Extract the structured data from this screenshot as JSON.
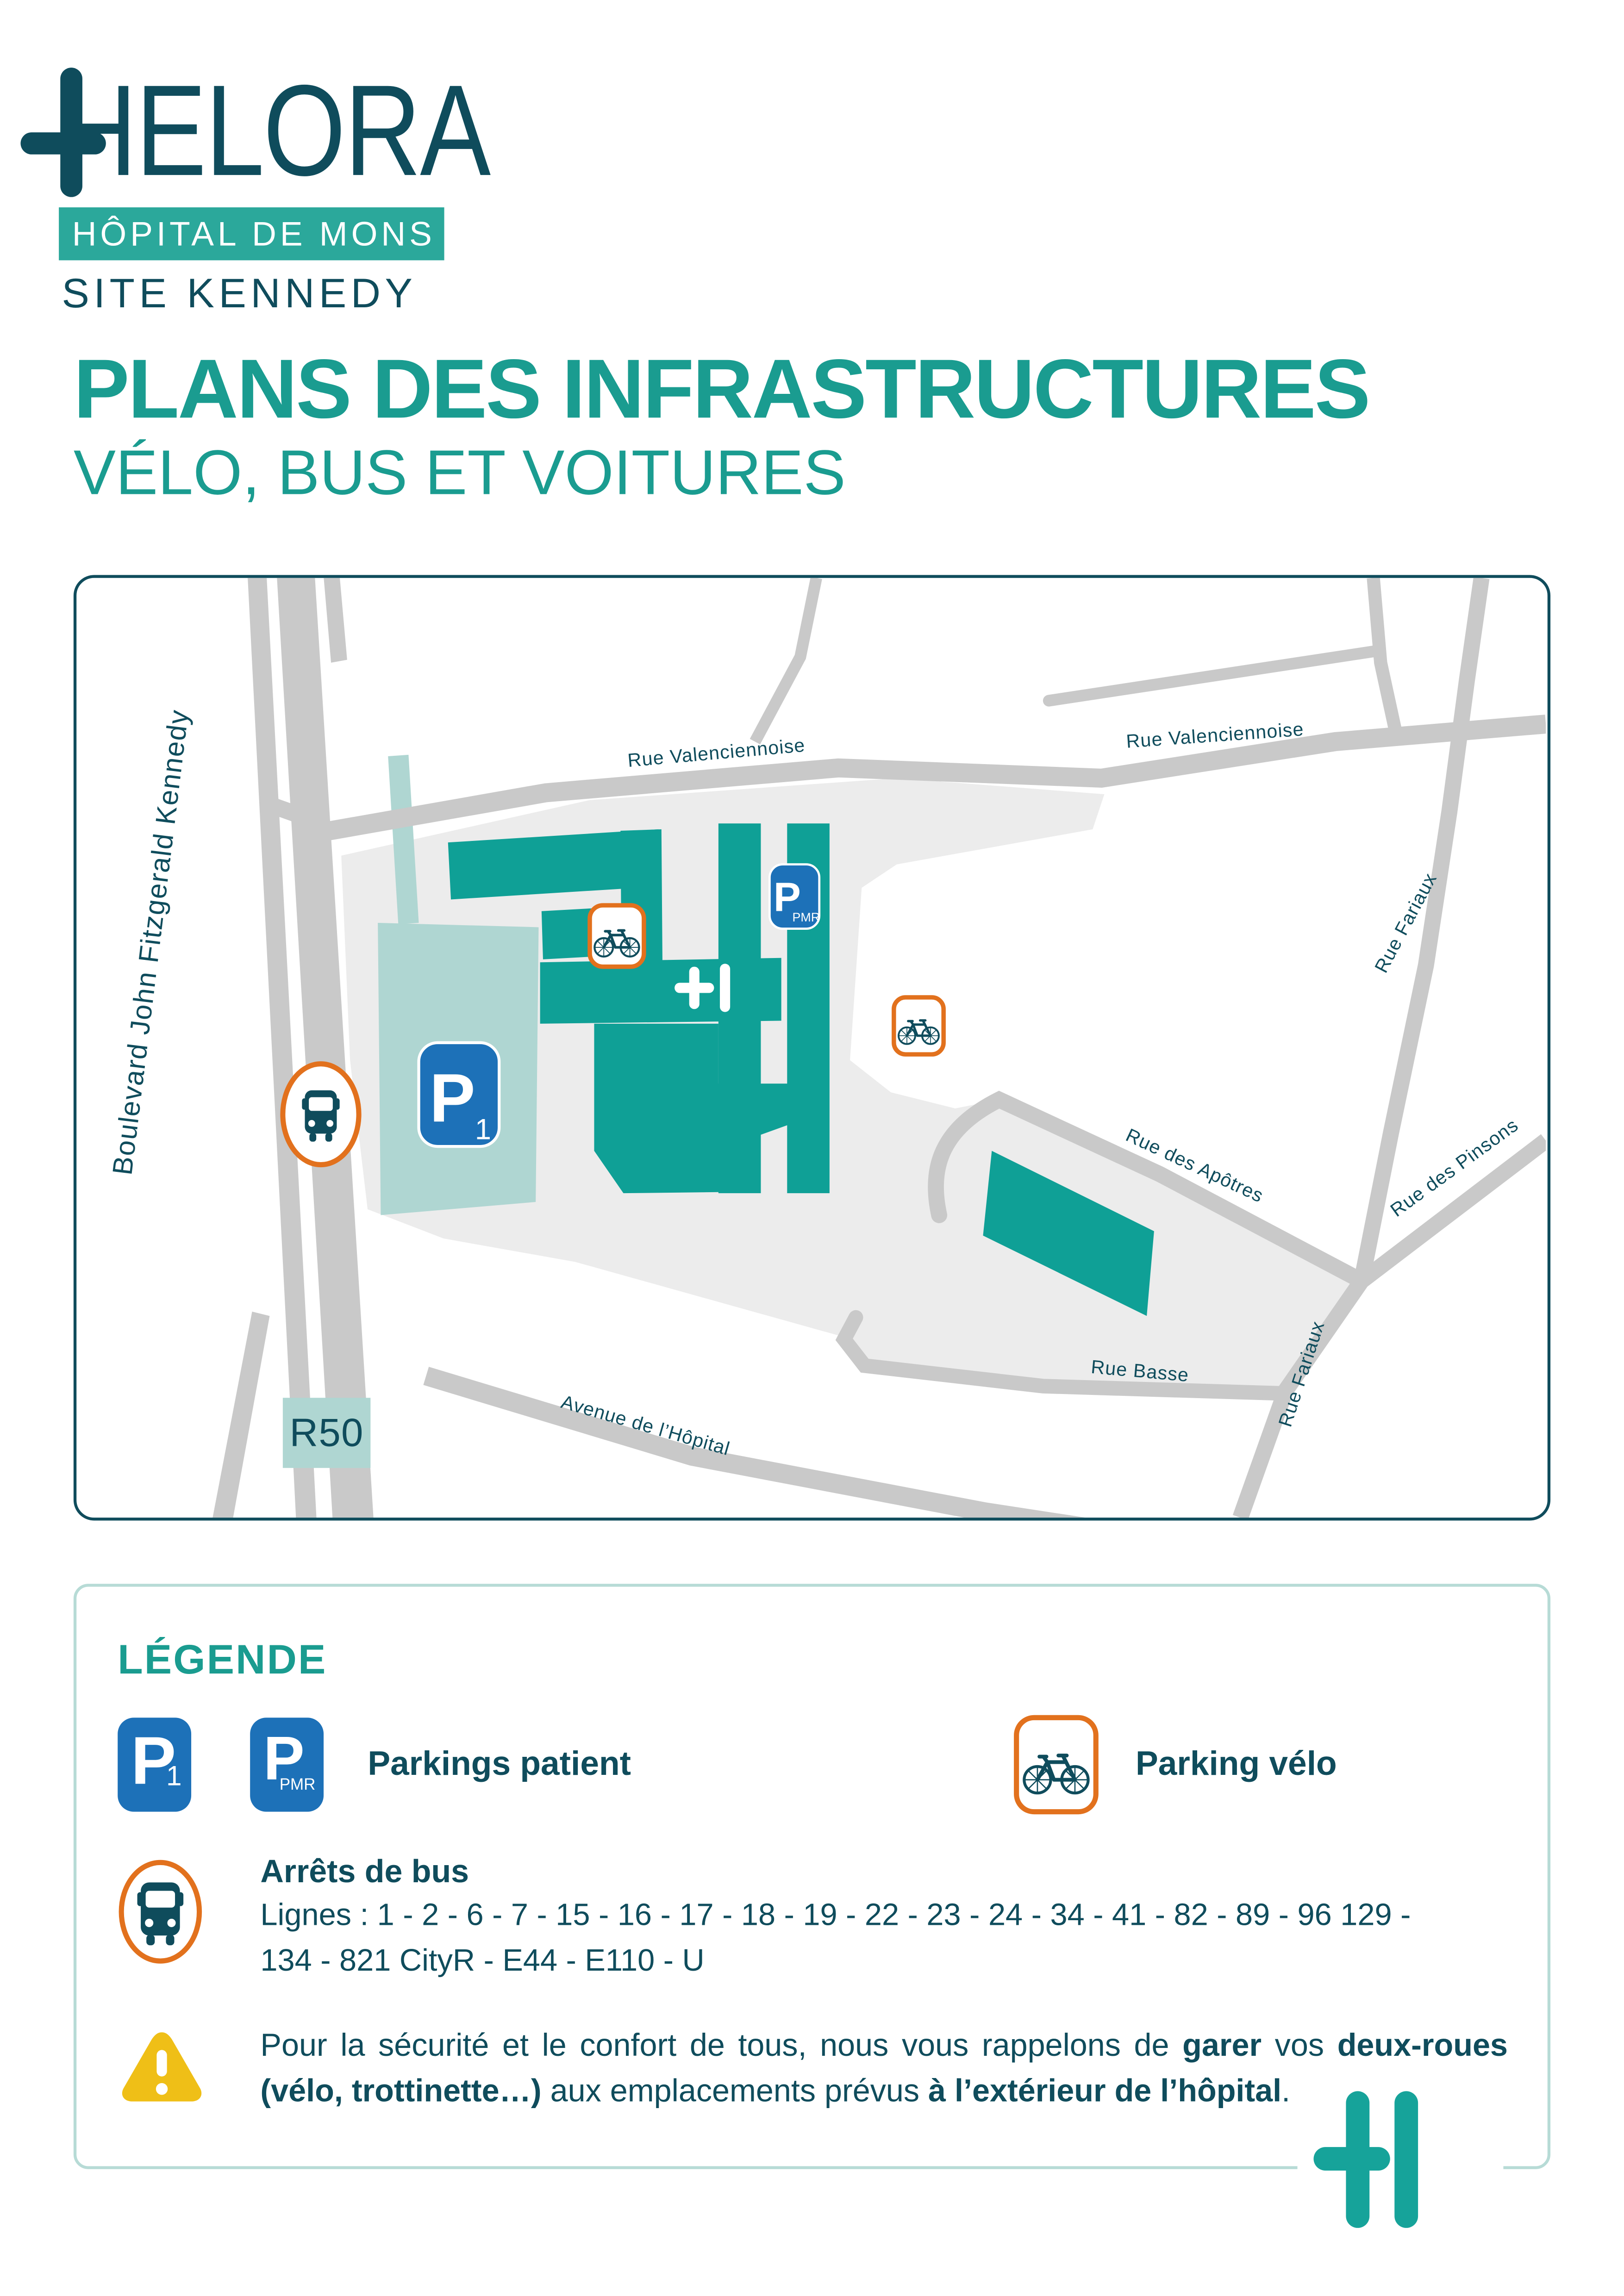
{
  "brand": {
    "wordmark": "HELORA",
    "hospital": "HÔPITAL DE MONS",
    "site": "SITE KENNEDY"
  },
  "title": {
    "line1": "PLANS DES INFRASTRUCTURES",
    "line2": "VÉLO, BUS ET VOITURES"
  },
  "map": {
    "streets": {
      "boulevard": "Boulevard John Fitzgerald Kennedy",
      "valenciennoise": "Rue Valenciennoise",
      "fariaux": "Rue Fariaux",
      "pinsons": "Rue des Pinsons",
      "apotres": "Rue des Apôtres",
      "basse": "Rue Basse",
      "avenue": "Avenue de l’Hôpital",
      "ring": "R50"
    },
    "signs": {
      "p": "P",
      "p1_sub": "1",
      "pmr_sub": "PMR"
    }
  },
  "legend": {
    "heading": "LÉGENDE",
    "parkings": {
      "amp": "&",
      "label": "Parkings patient"
    },
    "velo": {
      "label": "Parking vélo"
    },
    "bus": {
      "title": "Arrêts de bus",
      "lines1": "Lignes : 1 - 2 - 6 - 7 - 15 - 16 - 17 - 18 - 19 - 22 - 23 - 24 - 34 - 41 - 82 - 89 - 96 129 -",
      "lines2": "134 - 821 CityR - E44 - E110 - U"
    },
    "warning": {
      "segments": [
        {
          "t": "Pour la sécurité et le confort de tous, nous vous rappelons de ",
          "b": false
        },
        {
          "t": "garer",
          "b": true
        },
        {
          "t": " vos ",
          "b": false
        },
        {
          "t": "deux-roues (vélo, trottinette…)",
          "b": true
        },
        {
          "t": " aux emplacements prévus ",
          "b": false
        },
        {
          "t": "à l’extérieur de l’hôpital",
          "b": true
        },
        {
          "t": ".",
          "b": false
        }
      ]
    }
  },
  "colors": {
    "teal_title": "#1A9C90",
    "petrol_text": "#0F4C5C",
    "building_teal": "#0FA096",
    "banner_teal": "#2BA89B",
    "parking_blue": "#1D71B8",
    "orange": "#E2711D",
    "warning_yellow": "#EFBF17",
    "road_gray": "#C9C9C9",
    "campus_gray": "#ECECEC",
    "light_teal": "#AFD6D2"
  }
}
